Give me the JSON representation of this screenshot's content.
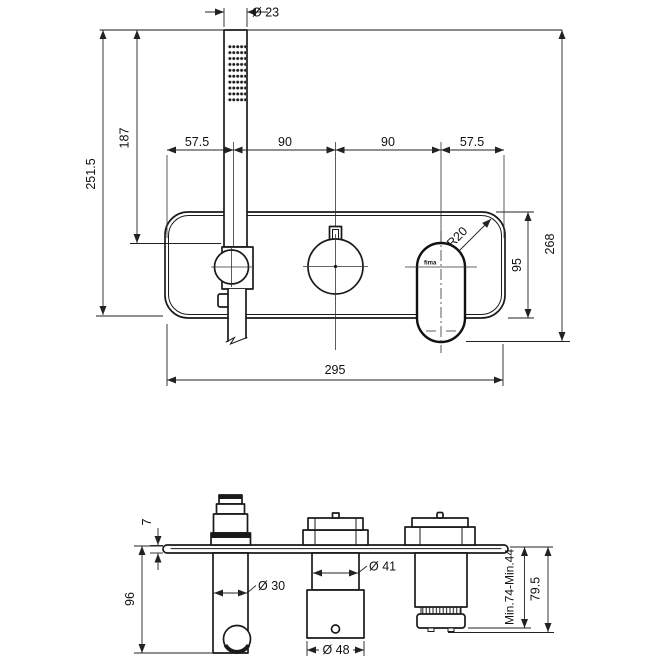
{
  "drawing": {
    "background": "#ffffff",
    "line_color": "#1a1a1a",
    "logo": "fima",
    "front_view": {
      "dims": {
        "handshower_diameter": "Ø 23",
        "overall_drop": "251.5",
        "handshower_length": "187",
        "left_margin": "57.5",
        "spacing_left": "90",
        "spacing_right": "90",
        "right_margin": "57.5",
        "total_height": "268",
        "corner_radius": "R20",
        "plate_height": "95",
        "plate_width": "295"
      }
    },
    "side_view": {
      "dims": {
        "plate_thickness": "7",
        "body_depth": "96",
        "holder_diameter": "Ø 30",
        "valve_neck_diameter": "Ø 41",
        "valve_body_diameter": "Ø 48",
        "rough_in_range": "Min.74-Min.44",
        "cartridge_depth": "79.5"
      }
    }
  }
}
